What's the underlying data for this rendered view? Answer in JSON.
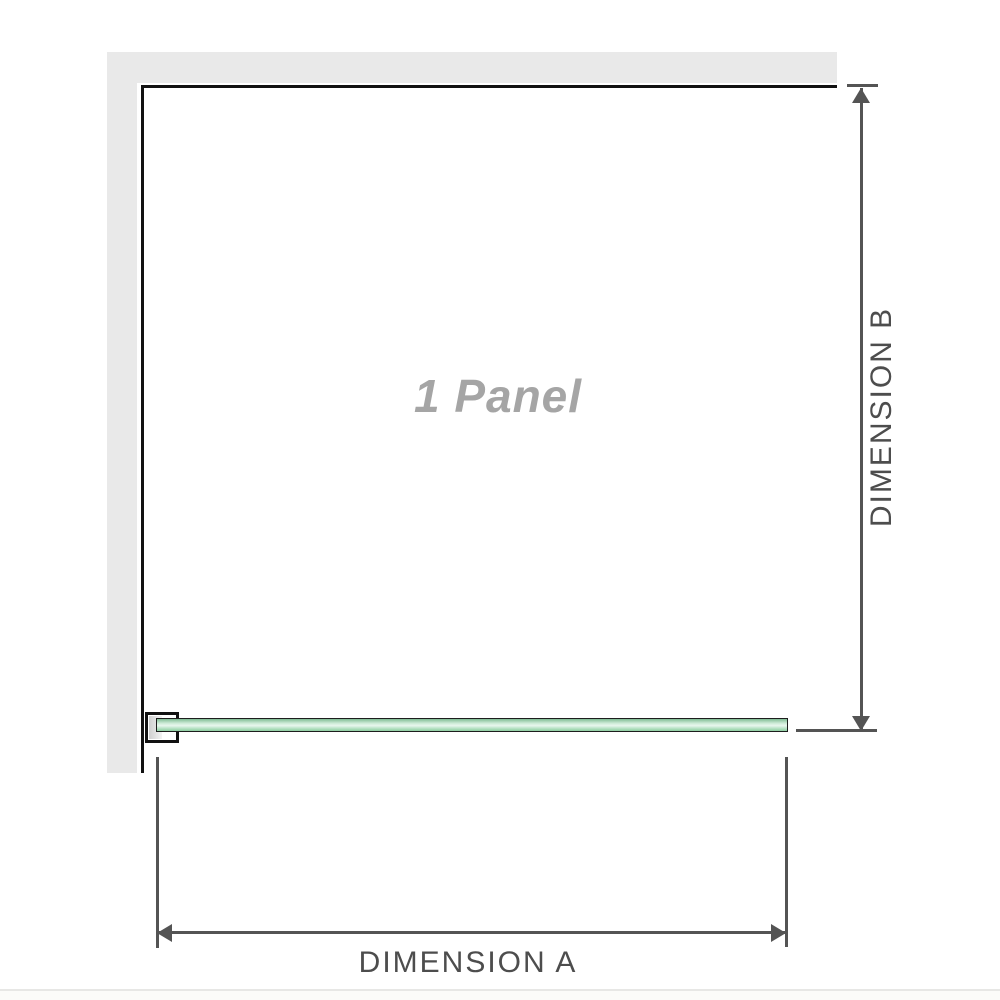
{
  "diagram": {
    "panel_label": "1 Panel",
    "dimension_a_label": "DIMENSION A",
    "dimension_b_label": "DIMENSION B"
  },
  "colors": {
    "background": "#ffffff",
    "wall_fill": "#e9e9e9",
    "panel_outline": "#111111",
    "glass_outline": "#1d1d1d",
    "glass_green_dark": "#7fbc93",
    "glass_green_mid": "#a9dcb8",
    "glass_green_light": "#e9f6ee",
    "dimension_line": "#545454",
    "label_text": "#4d4d4d",
    "panel_label_text": "#a5a5a5",
    "divider": "#e7e7e5"
  }
}
